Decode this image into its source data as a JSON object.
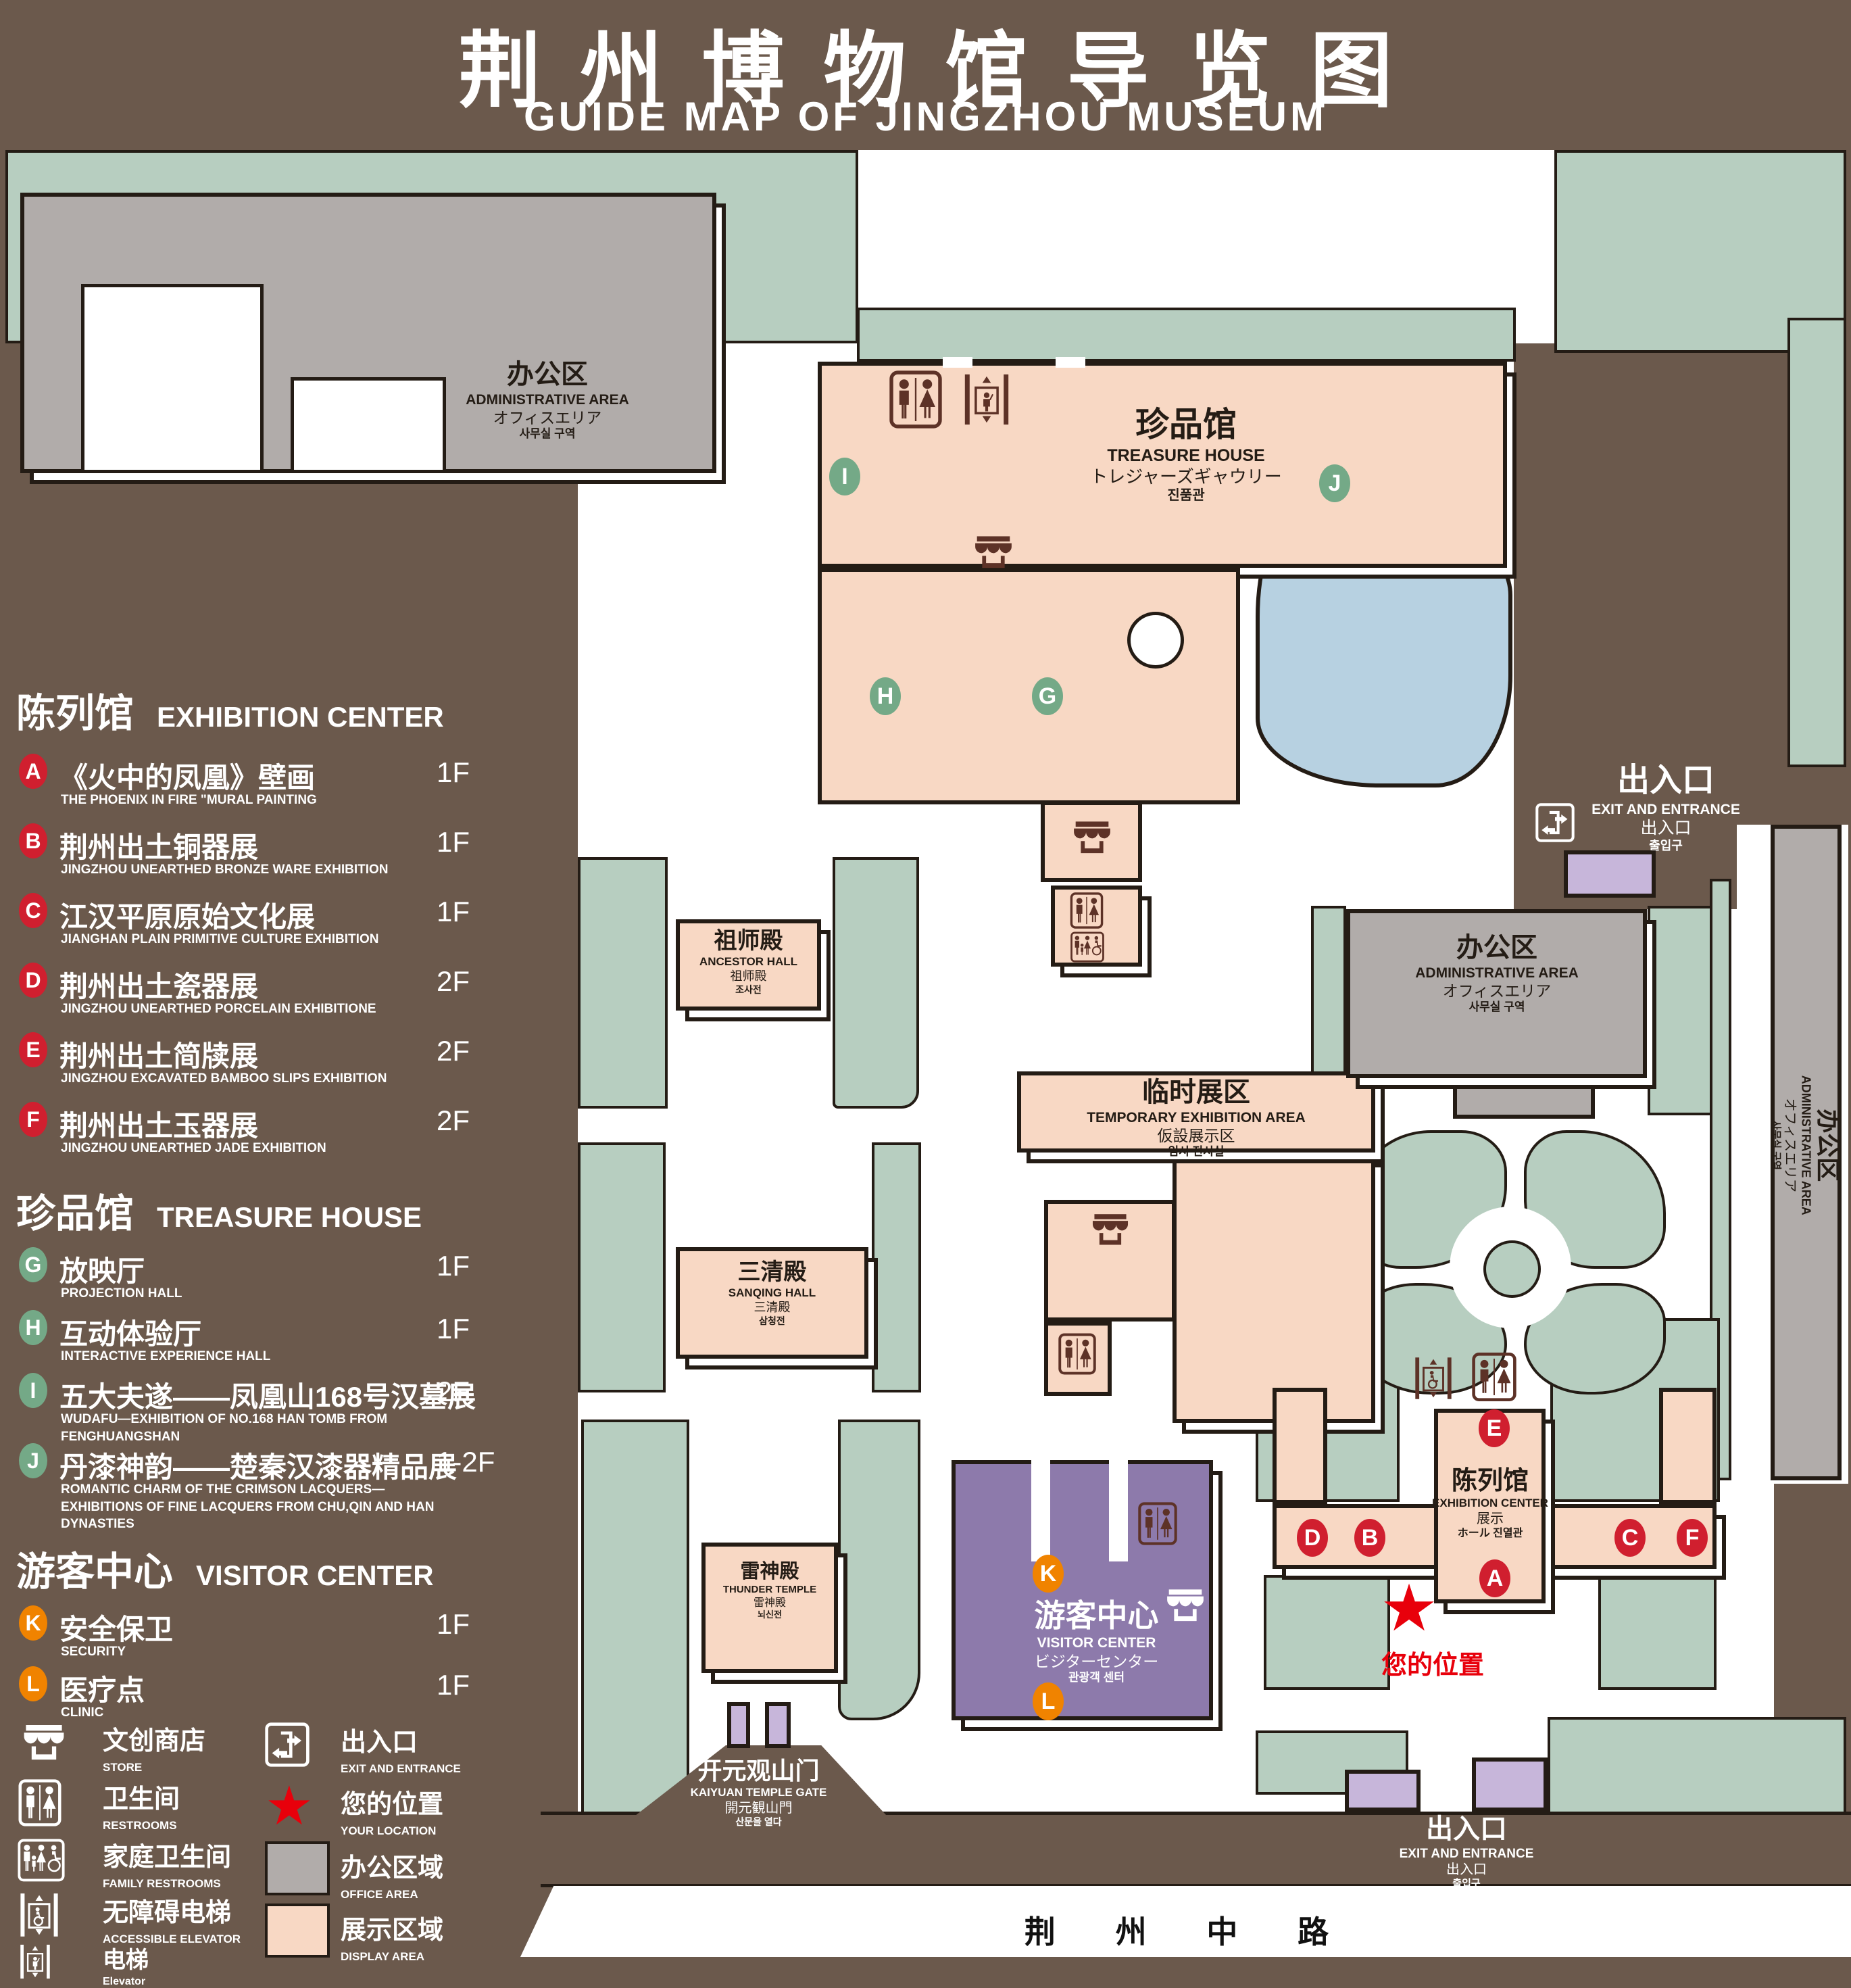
{
  "title": {
    "zh": "荆州博物馆导览图",
    "en": "GUIDE MAP OF JINGZHOU MUSEUM"
  },
  "colors": {
    "background": "#6b594c",
    "lawn_green": "#b7cec0",
    "display_area_pink": "#f8d8c4",
    "office_area_gray": "#b1acaa",
    "visitor_center_purple": "#8d7aab",
    "gate_purple": "#c7b6da",
    "pond_blue": "#b7d1e1",
    "badge_red": "#d01f2f",
    "badge_green": "#74a987",
    "badge_orange": "#f08300",
    "icon_brown": "#5d3227",
    "location_red": "#e8000b"
  },
  "legend": {
    "sections": [
      {
        "zh": "陈列馆",
        "en": "EXHIBITION CENTER",
        "items": [
          {
            "key": "A",
            "zh": "《火中的凤凰》壁画",
            "en": "THE PHOENIX IN FIRE \"MURAL PAINTING",
            "floor": "1F"
          },
          {
            "key": "B",
            "zh": "荆州出土铜器展",
            "en": "JINGZHOU UNEARTHED BRONZE WARE EXHIBITION",
            "floor": "1F"
          },
          {
            "key": "C",
            "zh": "江汉平原原始文化展",
            "en": "JIANGHAN PLAIN PRIMITIVE CULTURE EXHIBITION",
            "floor": "1F"
          },
          {
            "key": "D",
            "zh": "荆州出土瓷器展",
            "en": "JINGZHOU UNEARTHED PORCELAIN EXHIBITIONE",
            "floor": "2F"
          },
          {
            "key": "E",
            "zh": "荆州出土简牍展",
            "en": "JINGZHOU EXCAVATED BAMBOO SLIPS EXHIBITION",
            "floor": "2F"
          },
          {
            "key": "F",
            "zh": "荆州出土玉器展",
            "en": "JINGZHOU UNEARTHED JADE EXHIBITION",
            "floor": "2F"
          }
        ]
      },
      {
        "zh": "珍品馆",
        "en": "TREASURE HOUSE",
        "items": [
          {
            "key": "G",
            "zh": "放映厅",
            "en": "PROJECTION HALL",
            "floor": "1F"
          },
          {
            "key": "H",
            "zh": "互动体验厅",
            "en": "INTERACTIVE EXPERIENCE HALL",
            "floor": "1F"
          },
          {
            "key": "I",
            "zh": "五大夫遂——凤凰山168号汉墓展",
            "en": "WUDAFU—EXHIBITION OF NO.168 HAN TOMB FROM FENGHUANGSHAN",
            "floor": "2F"
          },
          {
            "key": "J",
            "zh": "丹漆神韵——楚秦汉漆器精品展",
            "en": "ROMANTIC CHARM OF THE CRIMSON LACQUERS—EXHIBITIONS OF FINE LACQUERS FROM CHU,QIN AND HAN DYNASTIES",
            "floor": "1-2F"
          }
        ]
      },
      {
        "zh": "游客中心",
        "en": "VISITOR CENTER",
        "items": [
          {
            "key": "K",
            "zh": "安全保卫",
            "en": "SECURITY",
            "floor": "1F"
          },
          {
            "key": "L",
            "zh": "医疗点",
            "en": "CLINIC",
            "floor": "1F"
          }
        ]
      }
    ],
    "symbols": {
      "left": [
        {
          "icon": "store-icon",
          "zh": "文创商店",
          "en": "STORE"
        },
        {
          "icon": "restrooms-icon",
          "zh": "卫生间",
          "en": "RESTROOMS"
        },
        {
          "icon": "family-restrooms-icon",
          "zh": "家庭卫生间",
          "en": "FAMILY RESTROOMS"
        },
        {
          "icon": "accessible-elevator-icon",
          "zh": "无障碍电梯",
          "en": "ACCESSIBLE ELEVATOR"
        },
        {
          "icon": "elevator-icon",
          "zh": "电梯",
          "en": "Elevator"
        }
      ],
      "right": [
        {
          "icon": "exit-icon",
          "zh": "出入口",
          "en": "EXIT AND ENTRANCE"
        },
        {
          "icon": "location-star-icon",
          "zh": "您的位置",
          "en": "YOUR LOCATION"
        },
        {
          "icon": "office-swatch",
          "zh": "办公区域",
          "en": "OFFICE AREA"
        },
        {
          "icon": "display-swatch",
          "zh": "展示区域",
          "en": "DISPLAY AREA"
        }
      ]
    }
  },
  "map": {
    "buildings": {
      "admin": {
        "zh": "办公区",
        "en": "ADMINISTRATIVE AREA",
        "ja": "オフィスエリア",
        "ko": "사무실 구역"
      },
      "treasure_house": {
        "zh": "珍品馆",
        "en": "TREASURE HOUSE",
        "ja": "トレジャーズギャウリー",
        "ko": "진품관"
      },
      "ancestor_hall": {
        "zh": "祖师殿",
        "en": "ANCESTOR HALL",
        "ja": "祖师殿",
        "ko": "조사전"
      },
      "temporary_exhibition": {
        "zh": "临时展区",
        "en": "TEMPORARY EXHIBITION AREA",
        "ja": "仮設展示区",
        "ko": "임시 전시실"
      },
      "sanqing_hall": {
        "zh": "三清殿",
        "en": "SANQING HALL",
        "ja": "三清殿",
        "ko": "삼청전"
      },
      "thunder_temple": {
        "zh": "雷神殿",
        "en": "THUNDER TEMPLE",
        "ja": "雷神殿",
        "ko": "뇌신전"
      },
      "visitor_center": {
        "zh": "游客中心",
        "en": "VISITOR CENTER",
        "ja": "ビジターセンター",
        "ko": "관광객 센터"
      },
      "exhibition_center": {
        "zh": "陈列馆",
        "en": "EXHIBITION CENTER",
        "ja": "展示",
        "ko": "ホール 진열관"
      }
    },
    "exit": {
      "zh": "出入口",
      "en": "EXIT AND ENTRANCE",
      "ja": "出入口",
      "ko": "출입구"
    },
    "gate": {
      "zh": "开元观山门",
      "en": "KAIYUAN TEMPLE GATE",
      "ja": "開元観山門",
      "ko": "산문을 열다"
    },
    "road": "荆 州 中 路",
    "your_location": "您的位置",
    "markers": {
      "a": "A",
      "b": "B",
      "c": "C",
      "d": "D",
      "e": "E",
      "f": "F",
      "g": "G",
      "h": "H",
      "i": "I",
      "j": "J",
      "k": "K",
      "l": "L"
    }
  }
}
